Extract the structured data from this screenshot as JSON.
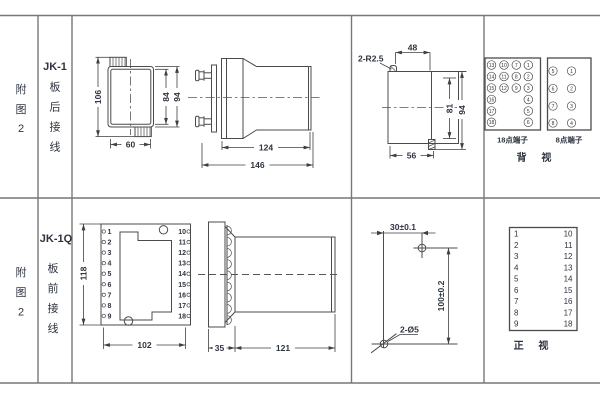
{
  "colors": {
    "line": "#4b4b4b",
    "grid": "#777777",
    "text": "#2e3440",
    "background": "#ffffff"
  },
  "row1": {
    "fig": [
      "附",
      "图",
      "2"
    ],
    "model": "JK-1",
    "wiring": [
      "板",
      "后",
      "接",
      "线"
    ],
    "front": {
      "dim_total_h": "106",
      "dim_inner_h": "84",
      "dim_outer_h": "94",
      "dim_w": "60"
    },
    "side": {
      "dim_body": "124",
      "dim_total": "146"
    },
    "rear": {
      "note_radius": "2-R2.5",
      "dim_top": "48",
      "dim_inner_h": "81",
      "dim_outer_h": "94",
      "dim_bottom": "56"
    },
    "t18": {
      "label": "18点端子",
      "rows": [
        [
          "13",
          "10",
          "7",
          "1"
        ],
        [
          "14",
          "11",
          "8",
          "2"
        ],
        [
          "15",
          "12",
          "9",
          "3"
        ],
        [
          "16",
          "4"
        ],
        [
          "17",
          "5"
        ],
        [
          "18",
          "6"
        ]
      ]
    },
    "t8": {
      "label": "8点端子",
      "rows": [
        [
          "5",
          "1"
        ],
        [
          "6",
          "2"
        ],
        [
          "7",
          "3"
        ],
        [
          "8",
          "4"
        ]
      ]
    },
    "view": "背 视"
  },
  "row2": {
    "fig": [
      "附",
      "图",
      "2"
    ],
    "model": "JK-1Q",
    "wiring": [
      "板",
      "前",
      "接",
      "线"
    ],
    "front": {
      "dim_h": "118",
      "dim_w": "102",
      "left": [
        "1",
        "2",
        "3",
        "4",
        "5",
        "6",
        "7",
        "8",
        "9"
      ],
      "right": [
        "10",
        "11",
        "12",
        "13",
        "14",
        "15",
        "16",
        "17",
        "18"
      ]
    },
    "side": {
      "dim_flange": "35",
      "dim_body": "121"
    },
    "drill": {
      "dim_x": "30±0.1",
      "dim_y": "100±0.2",
      "note_holes": "2-Ø5"
    },
    "table": {
      "left": [
        "1",
        "2",
        "3",
        "4",
        "5",
        "6",
        "7",
        "8",
        "9"
      ],
      "right": [
        "10",
        "11",
        "12",
        "13",
        "14",
        "15",
        "16",
        "17",
        "18"
      ],
      "view": "正 视"
    }
  }
}
